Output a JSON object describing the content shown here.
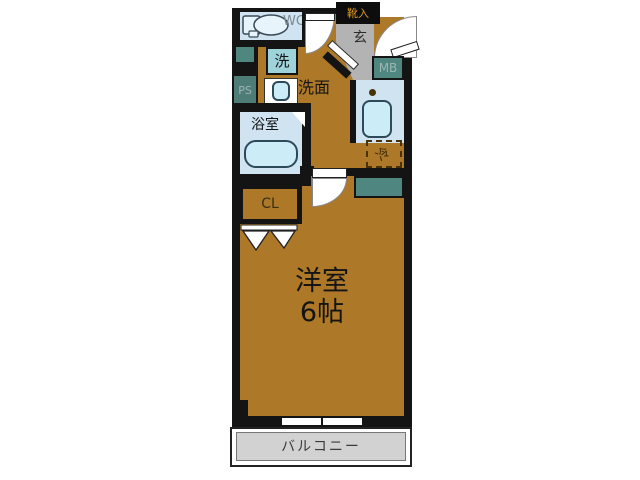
{
  "floorplan": {
    "labels": {
      "wc": "WC",
      "washer": "洗",
      "washroom": "洗面",
      "pipe_space": "PS",
      "bathroom": "浴室",
      "closet": "CL",
      "shoe_cabinet": "靴入",
      "entrance": "玄",
      "meter_box": "MB",
      "refrigerator": "冷",
      "main_room_name": "洋室",
      "main_room_size": "6帖",
      "balcony": "バルコニー"
    },
    "colors": {
      "floor_brown": "#ad7827",
      "wall_black": "#141414",
      "wet_area_blue": "#cfe4f0",
      "fixture_cyan": "#ccecf8",
      "utility_teal": "#4f8680",
      "entrance_gray": "#b3b3b3",
      "balcony_gray": "#d2d2d2",
      "shoe_label_orange": "#e09a1e"
    }
  }
}
